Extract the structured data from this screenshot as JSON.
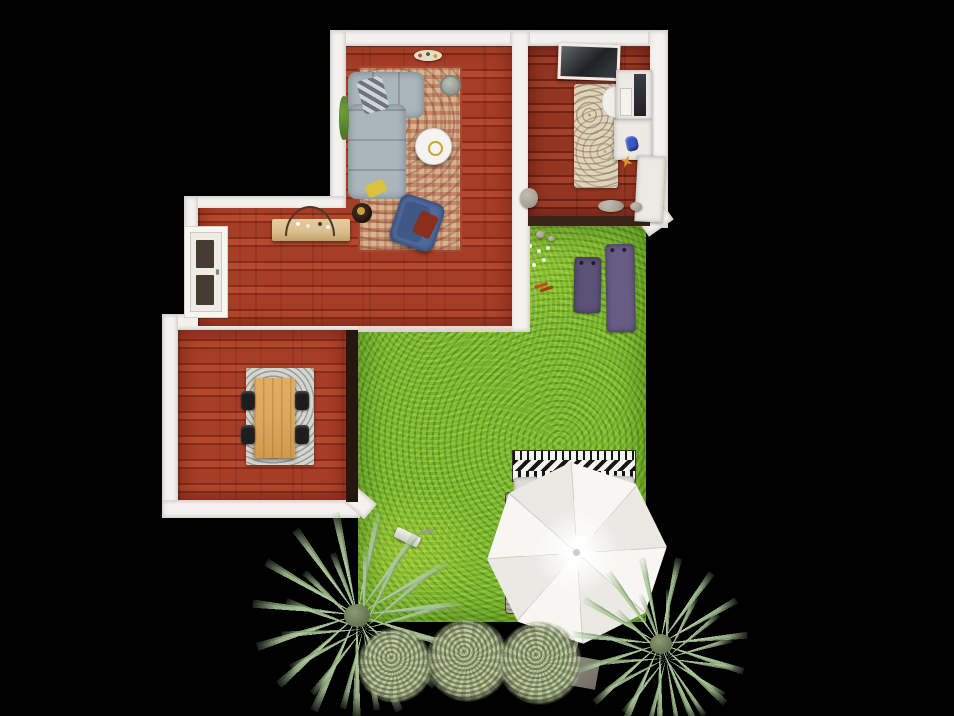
{
  "scene": {
    "type": "3d-home-design-top-view-render",
    "background": "#000000",
    "rooms": [
      {
        "id": "living-room",
        "floor": "red hardwood",
        "objects": [
          "gray-sectional-sofa",
          "plaid-throw",
          "yellow-pillow",
          "round-coffee-table",
          "oriental-rug",
          "blue-armchair",
          "red-cushion",
          "round-side-table",
          "ceiling-lamp",
          "potted-plant",
          "gray-planter"
        ]
      },
      {
        "id": "bedroom-office",
        "floor": "red hardwood",
        "objects": [
          "dark-headboard-panel",
          "beige-rug",
          "desk",
          "monitor",
          "keyboard",
          "desk-chair",
          "white-cabinet",
          "blue-bag",
          "orange-starfish",
          "stones"
        ]
      },
      {
        "id": "hallway",
        "floor": "red hardwood",
        "objects": [
          "console-table",
          "twig-wreath",
          "front-door"
        ]
      },
      {
        "id": "dining-room",
        "floor": "red hardwood",
        "objects": [
          "wooden-dining-table",
          "black-chair-x4",
          "speckled-rug"
        ]
      }
    ],
    "garden": {
      "ground": "green lawn",
      "objects": [
        "small-purple-yoga-mat",
        "large-purple-yoga-mat",
        "white-flowers",
        "red-sprig",
        "stones",
        "lawn-mower",
        "outdoor-daybed-aztec",
        "white-patio-umbrella",
        "umbrella-pole-and-base",
        "palm-tree-left",
        "palm-tree-right",
        "bush-left",
        "bush-center",
        "bush-right"
      ]
    }
  },
  "colors": {
    "background": "#000000",
    "wall": "#f3f2ef",
    "wall_edge": "#d9d6cf",
    "floor_red": "#a63d27",
    "floor_red_dark": "#8a2c1a",
    "floor_red_light": "#b4492e",
    "floor_bedroom": "#943522",
    "lawn": "#74b42c",
    "rug_living": "#d8b28b",
    "rug_living_accent": "#a84634",
    "rug_bedroom": "#ded3bd",
    "rug_bedroom_dot": "#8a715a",
    "rug_dining": "#d6d6d1",
    "sofa": "#aab6bc",
    "sofa_dark": "#8e9aa0",
    "armchair": "#4f6b9d",
    "armchair_dark": "#3f5886",
    "pillow_red": "#8a2e1e",
    "pillow_yellow": "#d9c33c",
    "coffee_white": "#f5f3ef",
    "gold": "#c9a23a",
    "console": "#dcc091",
    "twig": "#4c3a26",
    "door": "#efece6",
    "door_panel": "#473c32",
    "desk": "#eceae5",
    "monitor": "#202226",
    "chair_black": "#1d1d1d",
    "table_wood": "#dca85e",
    "table_wood_dark": "#b9823e",
    "yoga1": "#5c5176",
    "yoga2": "#675c84",
    "umbrella_a": "#f7f6f3",
    "umbrella_b": "#ebe9e4",
    "umbrella_seam": "#cfcdc6",
    "palm": "#adc89c",
    "palm_dark": "#87a276",
    "bush_a": "#c0caa3",
    "bush_b": "#9aa97e",
    "daybed_white": "#f3f3f0",
    "daybed_black": "#151515",
    "daybed_base": "#b5ae9d",
    "stone": "#a9a396",
    "metal": "#8a867c",
    "plant_green": "#4e7a2a",
    "blue_item": "#3a56c4",
    "orange_item": "#e0912f",
    "tv_dark": "#26282c"
  }
}
